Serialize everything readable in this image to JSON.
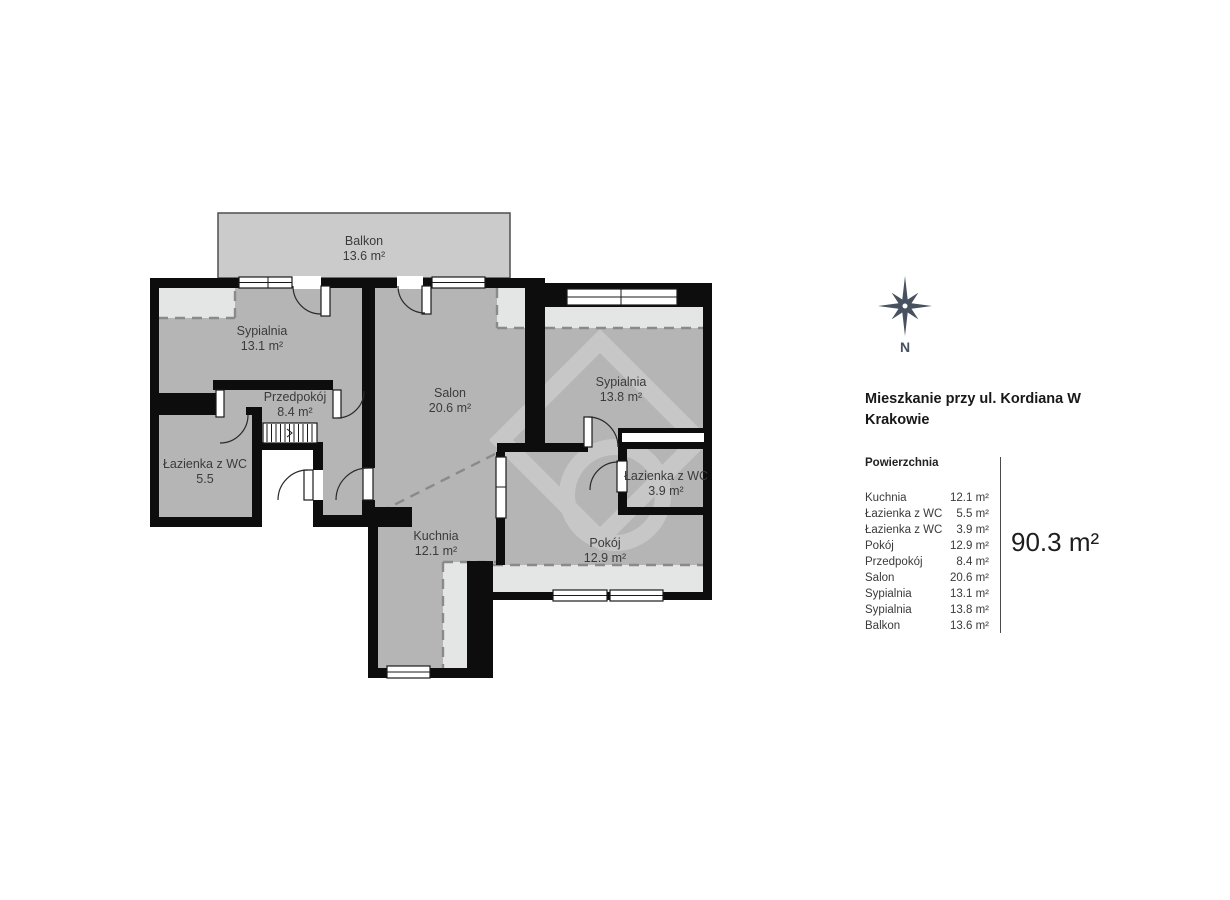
{
  "plan": {
    "rooms": [
      {
        "name": "Balkon",
        "area": "13.6 m²"
      },
      {
        "name": "Sypialnia",
        "area": "13.1 m²"
      },
      {
        "name": "Salon",
        "area": "20.6 m²"
      },
      {
        "name": "Sypialnia",
        "area": "13.8 m²"
      },
      {
        "name": "Przedpokój",
        "area": "8.4 m²"
      },
      {
        "name": "Łazienka z WC",
        "area": "5.5"
      },
      {
        "name": "Łazienka z WC",
        "area": "3.9 m²"
      },
      {
        "name": "Kuchnia",
        "area": "12.1 m²"
      },
      {
        "name": "Pokój",
        "area": "12.9 m²"
      }
    ],
    "compass_label": "N"
  },
  "sidebar": {
    "title_line1": "Mieszkanie przy ul. Kordiana W",
    "title_line2": "Krakowie",
    "section_header": "Powierzchnia",
    "items": [
      {
        "label": "Kuchnia",
        "value": "12.1 m²"
      },
      {
        "label": "Łazienka z WC",
        "value": "5.5 m²"
      },
      {
        "label": "Łazienka z WC",
        "value": "3.9 m²"
      },
      {
        "label": "Pokój",
        "value": "12.9 m²"
      },
      {
        "label": "Przedpokój",
        "value": "8.4 m²"
      },
      {
        "label": "Salon",
        "value": "20.6 m²"
      },
      {
        "label": "Sypialnia",
        "value": "13.1 m²"
      },
      {
        "label": "Sypialnia",
        "value": "13.8 m²"
      },
      {
        "label": "Balkon",
        "value": "13.6 m²"
      }
    ],
    "total": "90.3 m²"
  },
  "colors": {
    "wall": "#0d0d0d",
    "room_fill": "#b5b5b5",
    "balcony_fill": "#cbcbcb",
    "window_recess_fill": "#e3e6e4",
    "compass": "#48515f",
    "label_text": "#3b3b3b"
  }
}
